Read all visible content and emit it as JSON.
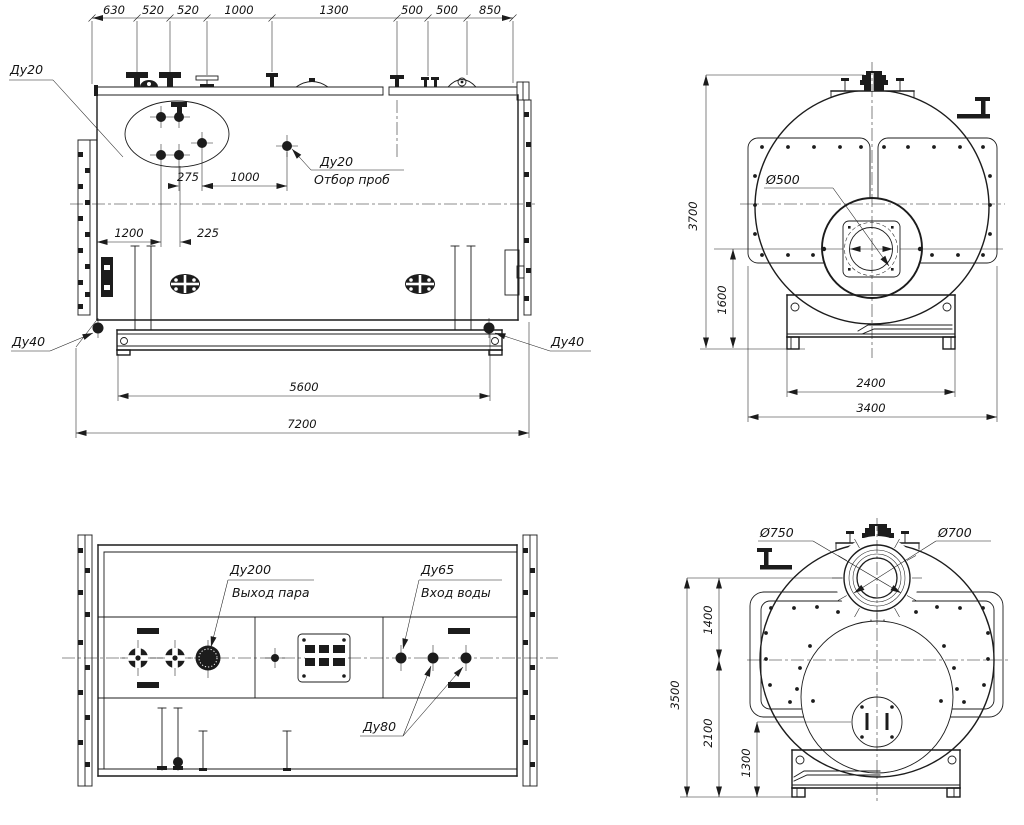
{
  "accent_colors": {
    "line": "#1c1c1c",
    "background": "#ffffff"
  },
  "side_view": {
    "top_dims": [
      "630",
      "520",
      "520",
      "1000",
      "1300",
      "500",
      "500",
      "850"
    ],
    "du20_label": "Ду20",
    "sample_du": "Ду20",
    "sample_name": "Отбор проб",
    "d275": "275",
    "d1000": "1000",
    "d1200": "1200",
    "d225": "225",
    "d5600": "5600",
    "d7200": "7200",
    "du40_left": "Ду40",
    "du40_right": "Ду40"
  },
  "front_view": {
    "d3700": "3700",
    "d1600": "1600",
    "d2400": "2400",
    "d3400": "3400",
    "d500": "Ø500"
  },
  "plan_view": {
    "du200": "Ду200",
    "steam_out": "Выход пара",
    "du65": "Ду65",
    "water_in": "Вход воды",
    "du80": "Ду80"
  },
  "rear_view": {
    "d750": "Ø750",
    "d700": "Ø700",
    "d1400": "1400",
    "d3500": "3500",
    "d2100": "2100",
    "d1300": "1300"
  }
}
